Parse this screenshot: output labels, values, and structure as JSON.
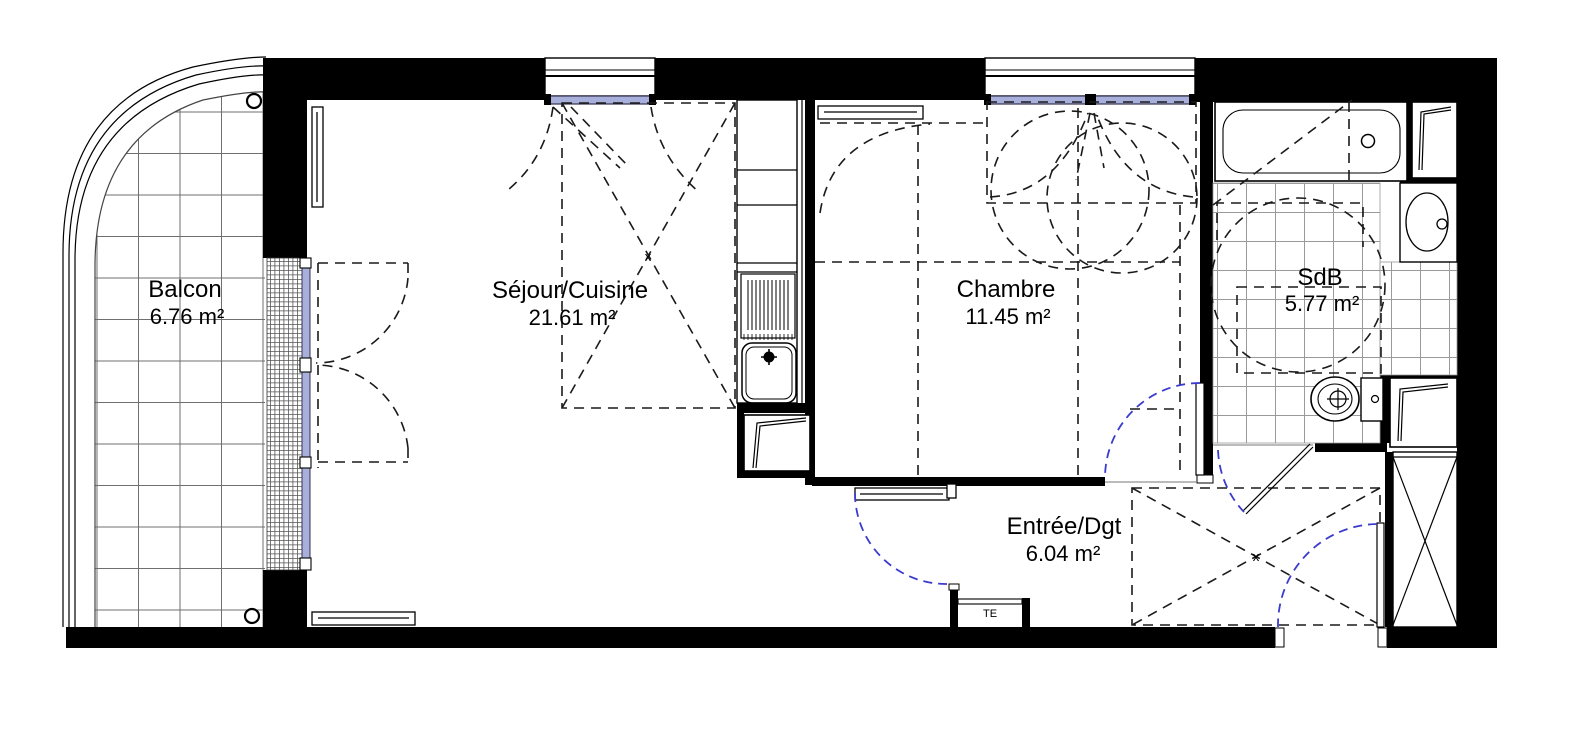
{
  "rooms": {
    "balcon": {
      "name": "Balcon",
      "area": "6.76 m²"
    },
    "sejour": {
      "name": "Séjour/Cuisine",
      "area": "21.61 m²"
    },
    "chambre": {
      "name": "Chambre",
      "area": "11.45 m²"
    },
    "sdb": {
      "name": "SdB",
      "area": "5.77 m²"
    },
    "entree": {
      "name": "Entrée/Dgt",
      "area": "6.04 m²"
    }
  },
  "annotations": {
    "electrical_panel": "TE",
    "cross_marker": "x"
  },
  "colors": {
    "wall": "#000000",
    "glazing": "#a9afdb",
    "door_swing": "#3b3bcd",
    "tile_line": "#8f8f8f"
  }
}
